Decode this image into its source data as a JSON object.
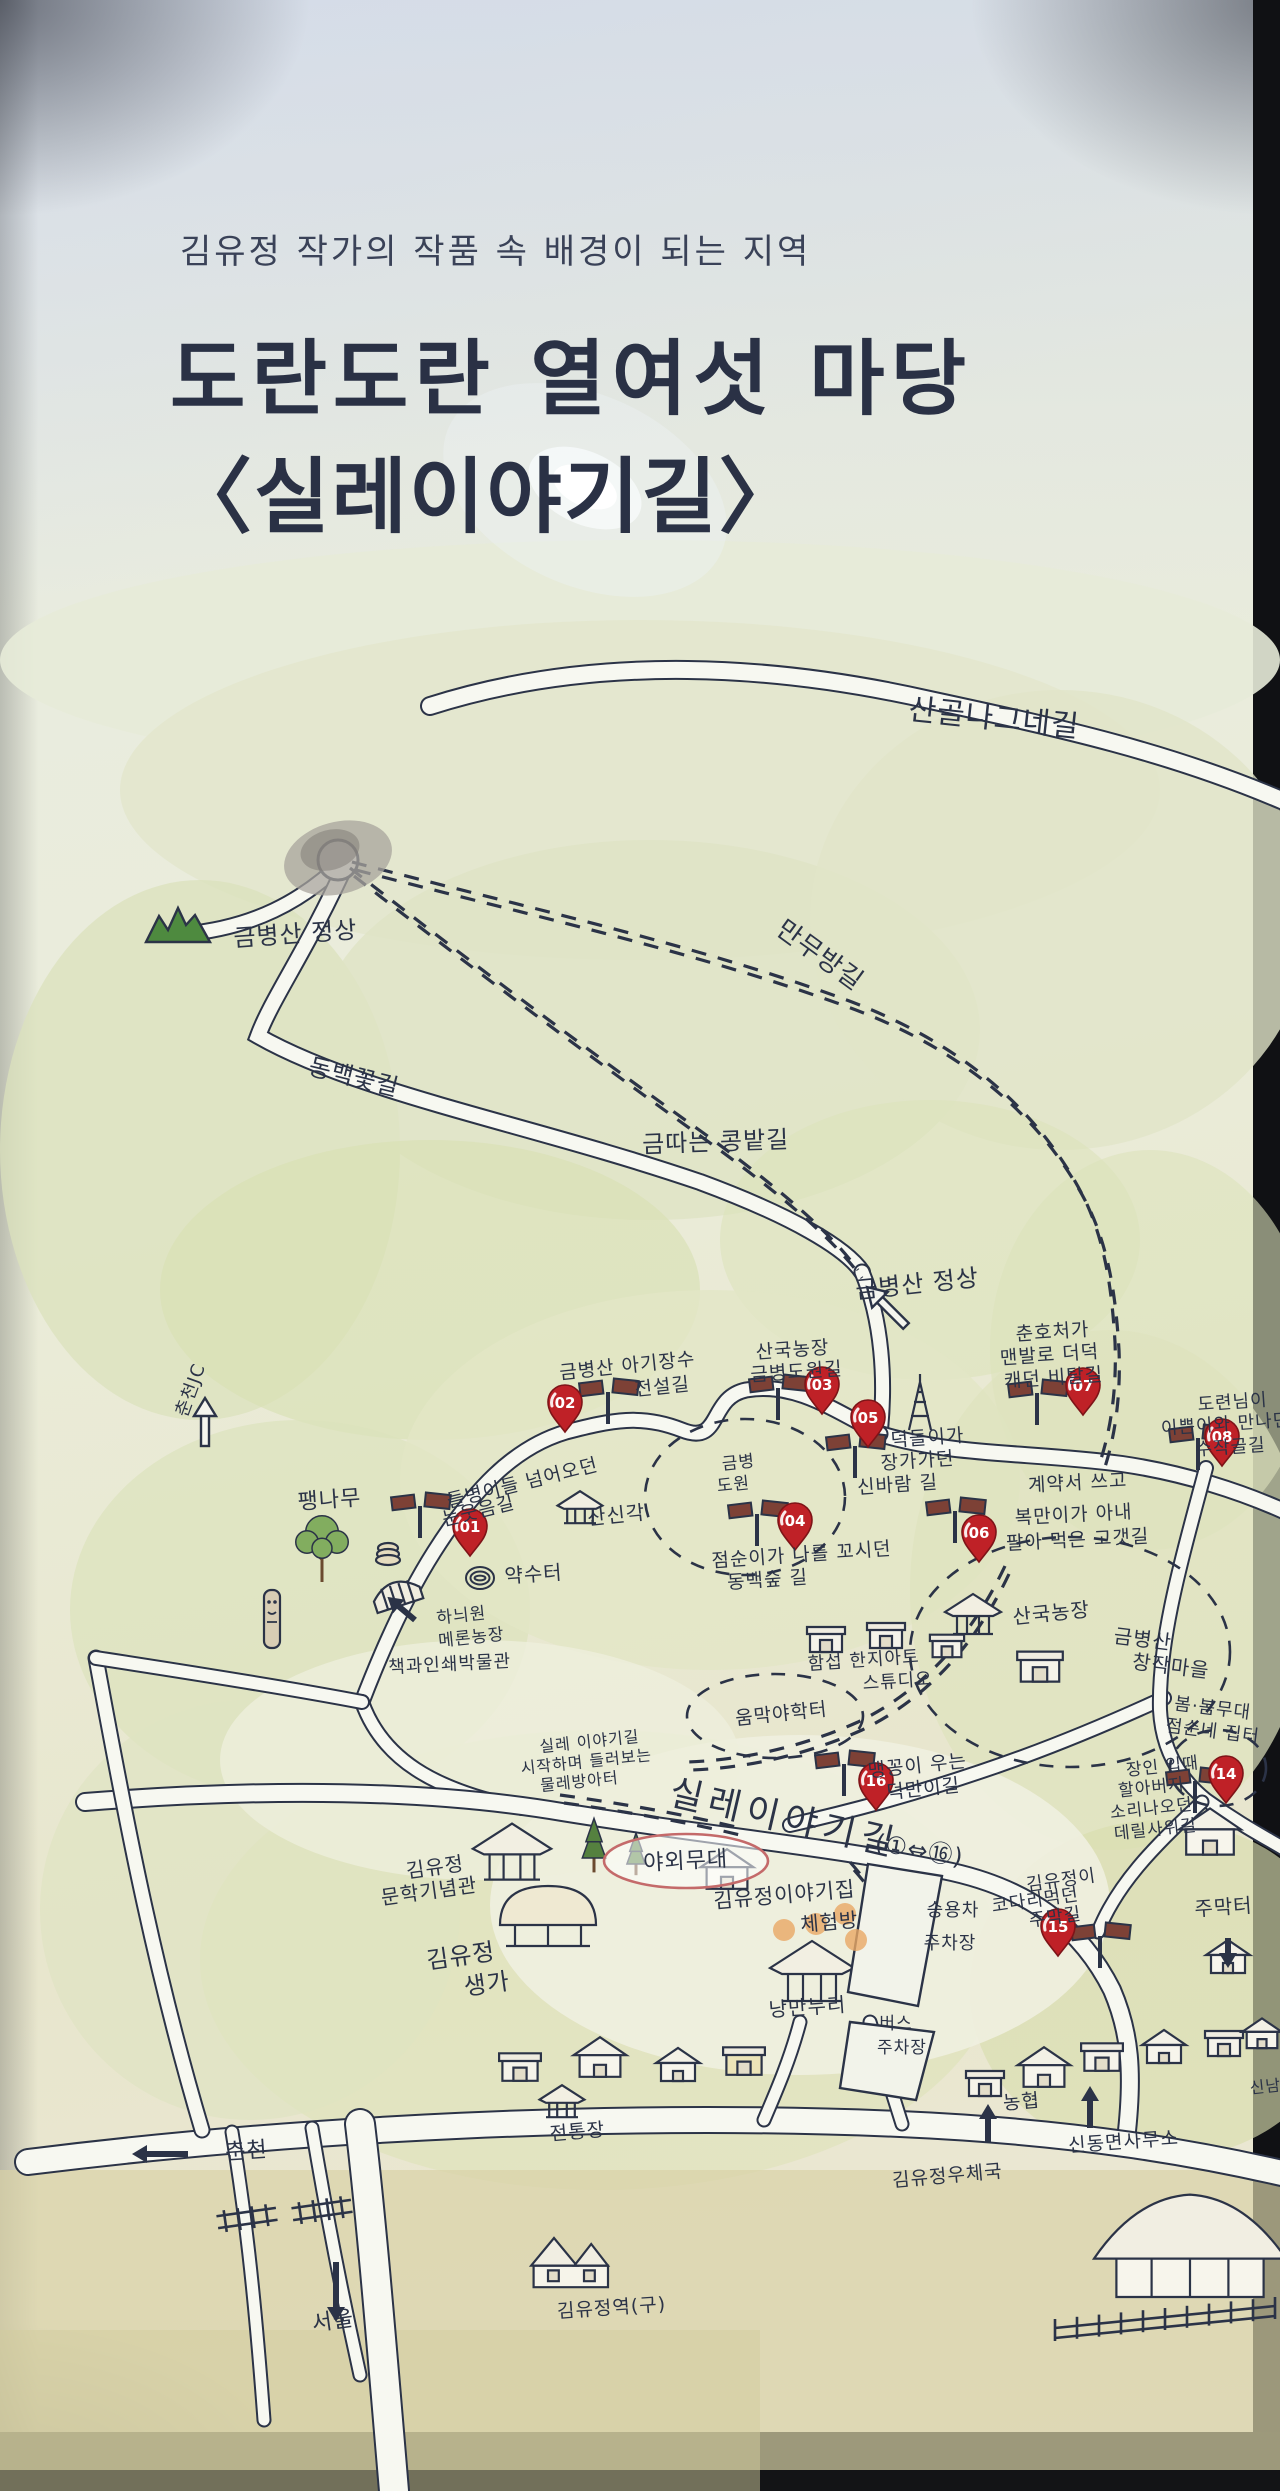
{
  "header": {
    "subtitle": "김유정 작가의 작품 속 배경이 되는 지역",
    "title_line1": "도란도란 열여섯 마당",
    "title_line2": "〈실레이야기길〉"
  },
  "map": {
    "colors": {
      "ink": "#2b3347",
      "road_fill": "#f7f8f1",
      "pin_red": "#bf2127",
      "pin_dark": "#7e1418",
      "sign_brown": "#7d4136",
      "tree_green": "#55813f",
      "leaf_green": "#82ad5f",
      "mountain_green": "#4e8a3f",
      "highlight_orange": "#e9a865",
      "stage_oval": "#c46a6a"
    },
    "route_range": "(①⇔⑯)",
    "pins": [
      {
        "num": "01",
        "label": "들병이들 넘어오던 눈웃음길",
        "x": 470,
        "y": 1546
      },
      {
        "num": "02",
        "label": "금병산 아기장수 전설길",
        "x": 565,
        "y": 1422
      },
      {
        "num": "03",
        "label": "산국농장 금병도원길",
        "x": 822,
        "y": 1404
      },
      {
        "num": "04",
        "label": "점순이가 나를 꼬시던 동백숲길",
        "x": 795,
        "y": 1540
      },
      {
        "num": "05",
        "label": "덕돌이가 장가가던 신바람길",
        "x": 868,
        "y": 1437
      },
      {
        "num": "06",
        "label": "계약서 쓰고 복만이가 아내 팔아먹은 고갯길",
        "x": 979,
        "y": 1552
      },
      {
        "num": "07",
        "label": "춘호처가 맨발로 더덕 캐던 비탈길",
        "x": 1083,
        "y": 1405
      },
      {
        "num": "08",
        "label": "도련님이 이쁜이와 만나던 수작골길",
        "x": 1222,
        "y": 1456
      },
      {
        "num": "14",
        "label": "장인 입때 할아버지 소리나오던 데릴사위길",
        "x": 1226,
        "y": 1793
      },
      {
        "num": "15",
        "label": "김유정이 코다리먹던 주막길",
        "x": 1058,
        "y": 1946
      },
      {
        "num": "16",
        "label": "맹꽁이 우는 덕만이길",
        "x": 876,
        "y": 1800
      }
    ],
    "labels": [
      {
        "name": "trail-sangol-nagne",
        "text": "산골나그네길",
        "x": 993,
        "y": 728,
        "size": 30,
        "rot": 6
      },
      {
        "name": "trail-manmubang",
        "text": "만무방길",
        "x": 815,
        "y": 962,
        "size": 26,
        "rot": 36
      },
      {
        "name": "peak-geumbyeongsan-left",
        "text": "금병산 정상",
        "x": 296,
        "y": 942,
        "size": 24,
        "rot": -4
      },
      {
        "name": "trail-dongbaekkot",
        "text": "동백꽃길",
        "x": 352,
        "y": 1085,
        "size": 24,
        "rot": 14
      },
      {
        "name": "trail-geumttaneun-kongbat",
        "text": "금따는 콩밭길",
        "x": 716,
        "y": 1150,
        "size": 24,
        "rot": -2
      },
      {
        "name": "peak-geumbyeongsan-center",
        "text": "금병산 정상",
        "x": 918,
        "y": 1292,
        "size": 24,
        "rot": -6
      },
      {
        "name": "jc-chuncheon",
        "text": "춘천JC",
        "x": 196,
        "y": 1392,
        "size": 18,
        "rot": -70
      },
      {
        "name": "m07-line1",
        "text": "춘호처가",
        "x": 1053,
        "y": 1338,
        "size": 19,
        "rot": -4
      },
      {
        "name": "m07-line2",
        "text": "맨발로 더덕",
        "x": 1050,
        "y": 1361,
        "size": 19,
        "rot": -4
      },
      {
        "name": "m07-line3",
        "text": "캐던 비탈길",
        "x": 1054,
        "y": 1384,
        "size": 19,
        "rot": -4
      },
      {
        "name": "m02-line1",
        "text": "금병산 아기장수",
        "x": 628,
        "y": 1372,
        "size": 19,
        "rot": -6
      },
      {
        "name": "m02-line2",
        "text": "전설길",
        "x": 663,
        "y": 1393,
        "size": 19,
        "rot": -6
      },
      {
        "name": "m03-line1",
        "text": "산국농장",
        "x": 793,
        "y": 1356,
        "size": 19,
        "rot": -4
      },
      {
        "name": "m03-line2",
        "text": "금병도원길",
        "x": 797,
        "y": 1378,
        "size": 19,
        "rot": -4
      },
      {
        "name": "m08-line1",
        "text": "도련님이",
        "x": 1233,
        "y": 1408,
        "size": 18,
        "rot": -4
      },
      {
        "name": "m08-line2",
        "text": "이쁜이와 만나던",
        "x": 1226,
        "y": 1430,
        "size": 18,
        "rot": -4
      },
      {
        "name": "m08-line3",
        "text": "수작골길",
        "x": 1231,
        "y": 1453,
        "size": 18,
        "rot": -4
      },
      {
        "name": "m06-line1",
        "text": "계약서 쓰고",
        "x": 1078,
        "y": 1489,
        "size": 19,
        "rot": -3
      },
      {
        "name": "m06-line2",
        "text": "복만이가 아내",
        "x": 1074,
        "y": 1521,
        "size": 19,
        "rot": -3
      },
      {
        "name": "m06-line3",
        "text": "팔아 먹은 고갯길",
        "x": 1078,
        "y": 1546,
        "size": 19,
        "rot": -3
      },
      {
        "name": "m05-line1",
        "text": "덕돌이가",
        "x": 928,
        "y": 1444,
        "size": 19,
        "rot": -4
      },
      {
        "name": "m05-line2",
        "text": "장가가던",
        "x": 918,
        "y": 1467,
        "size": 19,
        "rot": -4
      },
      {
        "name": "m05-line3",
        "text": "신바람 길",
        "x": 898,
        "y": 1491,
        "size": 19,
        "rot": -4
      },
      {
        "name": "m01-line1",
        "text": "들병이들 넘어오던",
        "x": 524,
        "y": 1489,
        "size": 19,
        "rot": -14
      },
      {
        "name": "m01-line2",
        "text": "눈웃음길",
        "x": 480,
        "y": 1517,
        "size": 19,
        "rot": -14
      },
      {
        "name": "paengnamu",
        "text": "팽나무",
        "x": 330,
        "y": 1507,
        "size": 22,
        "rot": -4
      },
      {
        "name": "sansingak",
        "text": "산신각",
        "x": 617,
        "y": 1522,
        "size": 20,
        "rot": -6
      },
      {
        "name": "yaksuteo",
        "text": "약수터",
        "x": 534,
        "y": 1581,
        "size": 20,
        "rot": -4
      },
      {
        "name": "m04-line1",
        "text": "점순이가 나를 꼬시던",
        "x": 802,
        "y": 1561,
        "size": 19,
        "rot": -4
      },
      {
        "name": "m04-line2",
        "text": "동백숲 길",
        "x": 768,
        "y": 1586,
        "size": 19,
        "rot": -4
      },
      {
        "name": "melon-farm-line1",
        "text": "하늬원",
        "x": 462,
        "y": 1621,
        "size": 17,
        "rot": -6
      },
      {
        "name": "melon-farm-line2",
        "text": "메론농장",
        "x": 472,
        "y": 1643,
        "size": 17,
        "rot": -6
      },
      {
        "name": "book-print-museum",
        "text": "책과인쇄박물관",
        "x": 450,
        "y": 1670,
        "size": 18,
        "rot": -3
      },
      {
        "name": "geumbyeong-dowon-line1",
        "text": "금병",
        "x": 739,
        "y": 1468,
        "size": 17,
        "rot": -6
      },
      {
        "name": "geumbyeong-dowon-line2",
        "text": "도원",
        "x": 734,
        "y": 1490,
        "size": 17,
        "rot": -6
      },
      {
        "name": "sanguk-farm",
        "text": "산국농장",
        "x": 1052,
        "y": 1620,
        "size": 20,
        "rot": -6
      },
      {
        "name": "changjak-village-line1",
        "text": "금병산",
        "x": 1142,
        "y": 1646,
        "size": 20,
        "rot": 7
      },
      {
        "name": "changjak-village-line2",
        "text": "창작마을",
        "x": 1170,
        "y": 1673,
        "size": 20,
        "rot": 7
      },
      {
        "name": "hanji-studio-line1",
        "text": "함섭 한지아트",
        "x": 864,
        "y": 1666,
        "size": 18,
        "rot": -4
      },
      {
        "name": "hanji-studio-line2",
        "text": "스튜디오",
        "x": 898,
        "y": 1687,
        "size": 18,
        "rot": -4
      },
      {
        "name": "ummak-yahakteo",
        "text": "움막야학터",
        "x": 782,
        "y": 1720,
        "size": 19,
        "rot": -6
      },
      {
        "name": "bombom-stage-line1",
        "text": "봄·봄무대",
        "x": 1212,
        "y": 1714,
        "size": 18,
        "rot": 7
      },
      {
        "name": "bombom-stage-line2",
        "text": "점순네 집터",
        "x": 1212,
        "y": 1737,
        "size": 18,
        "rot": 7
      },
      {
        "name": "m16-line1",
        "text": "맹꽁이 우는",
        "x": 918,
        "y": 1772,
        "size": 19,
        "rot": -6
      },
      {
        "name": "m16-line2",
        "text": "덕만이길",
        "x": 924,
        "y": 1795,
        "size": 19,
        "rot": -6
      },
      {
        "name": "trail-start-line1",
        "text": "실레 이야기길",
        "x": 590,
        "y": 1747,
        "size": 16,
        "rot": -6
      },
      {
        "name": "trail-start-line2",
        "text": "시작하며 들러보는",
        "x": 587,
        "y": 1767,
        "size": 16,
        "rot": -6
      },
      {
        "name": "trail-start-line3",
        "text": "물레방아터",
        "x": 580,
        "y": 1787,
        "size": 16,
        "rot": -6
      },
      {
        "name": "m14-line1",
        "text": "장인 입때",
        "x": 1163,
        "y": 1772,
        "size": 17,
        "rot": -6
      },
      {
        "name": "m14-line2",
        "text": "할아버지",
        "x": 1152,
        "y": 1793,
        "size": 17,
        "rot": -6
      },
      {
        "name": "m14-line3",
        "text": "소리나오던",
        "x": 1152,
        "y": 1814,
        "size": 17,
        "rot": -6
      },
      {
        "name": "m14-line4",
        "text": "데릴사위길",
        "x": 1156,
        "y": 1835,
        "size": 17,
        "rot": -6
      },
      {
        "name": "main-trail-name",
        "text": "실레이야기길",
        "x": 782,
        "y": 1830,
        "size": 36,
        "rot": 13
      },
      {
        "name": "main-trail-range",
        "text": "(①⇔⑯)",
        "x": 918,
        "y": 1858,
        "size": 24,
        "rot": 10
      },
      {
        "name": "outdoor-stage",
        "text": "야외무대",
        "x": 686,
        "y": 1868,
        "size": 22,
        "rot": -3
      },
      {
        "name": "kimyoujeong-story-house",
        "text": "김유정이야기집",
        "x": 785,
        "y": 1902,
        "size": 21,
        "rot": -5
      },
      {
        "name": "experience-room",
        "text": "체험방",
        "x": 830,
        "y": 1929,
        "size": 20,
        "rot": -5
      },
      {
        "name": "nangmannuri",
        "text": "낭만누리",
        "x": 808,
        "y": 2014,
        "size": 20,
        "rot": -4
      },
      {
        "name": "car-parking-line1",
        "text": "승용차",
        "x": 953,
        "y": 1916,
        "size": 18,
        "rot": 0
      },
      {
        "name": "car-parking-line2",
        "text": "주차장",
        "x": 950,
        "y": 1949,
        "size": 18,
        "rot": 0
      },
      {
        "name": "m15-line1",
        "text": "김유정이",
        "x": 1062,
        "y": 1886,
        "size": 18,
        "rot": -8
      },
      {
        "name": "m15-line2",
        "text": "코다리먹던",
        "x": 1036,
        "y": 1906,
        "size": 18,
        "rot": -8
      },
      {
        "name": "m15-line3",
        "text": "주막길",
        "x": 1056,
        "y": 1923,
        "size": 18,
        "rot": -8
      },
      {
        "name": "jumakteo",
        "text": "주막터",
        "x": 1224,
        "y": 1914,
        "size": 20,
        "rot": -4
      },
      {
        "name": "literature-hall-line1",
        "text": "김유정",
        "x": 436,
        "y": 1874,
        "size": 20,
        "rot": -8
      },
      {
        "name": "literature-hall-line2",
        "text": "문학기념관",
        "x": 430,
        "y": 1898,
        "size": 20,
        "rot": -8
      },
      {
        "name": "birthplace-line1",
        "text": "김유정",
        "x": 462,
        "y": 1964,
        "size": 24,
        "rot": -8
      },
      {
        "name": "birthplace-line2",
        "text": "생가",
        "x": 488,
        "y": 1992,
        "size": 24,
        "rot": -8
      },
      {
        "name": "bus-parking-line1",
        "text": "버스",
        "x": 896,
        "y": 2029,
        "size": 17,
        "rot": 0
      },
      {
        "name": "bus-parking-line2",
        "text": "주차장",
        "x": 902,
        "y": 2053,
        "size": 17,
        "rot": 0
      },
      {
        "name": "traditional-market",
        "text": "전통장",
        "x": 578,
        "y": 2138,
        "size": 19,
        "rot": -5
      },
      {
        "name": "nonghyup",
        "text": "농협",
        "x": 1022,
        "y": 2108,
        "size": 19,
        "rot": -5
      },
      {
        "name": "post-office",
        "text": "김유정우체국",
        "x": 948,
        "y": 2182,
        "size": 19,
        "rot": -5
      },
      {
        "name": "township-office",
        "text": "신동면사무소",
        "x": 1124,
        "y": 2148,
        "size": 19,
        "rot": -4
      },
      {
        "name": "to-chuncheon",
        "text": "춘천",
        "x": 247,
        "y": 2158,
        "size": 22,
        "rot": -4
      },
      {
        "name": "to-seoul",
        "text": "서울",
        "x": 334,
        "y": 2328,
        "size": 22,
        "rot": -8
      },
      {
        "name": "old-station",
        "text": "김유정역(구)",
        "x": 612,
        "y": 2314,
        "size": 19,
        "rot": -4
      },
      {
        "name": "to-sinnam",
        "text": "신남",
        "x": 1266,
        "y": 2092,
        "size": 16,
        "rot": -6
      }
    ]
  }
}
